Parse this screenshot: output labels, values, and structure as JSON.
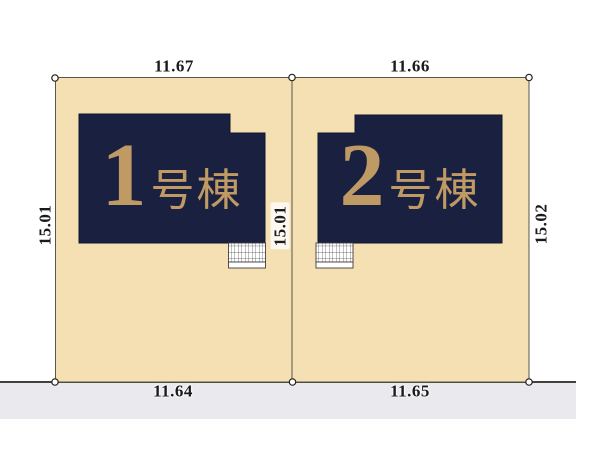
{
  "colors": {
    "lot_fill": "#F4E0B2",
    "building_fill": "#1A2140",
    "building_label": "#C09A64",
    "road_fill": "#E9E9EE",
    "boundary_line": "#44413A",
    "dimension_text": "#1A1A1A"
  },
  "buildings": [
    {
      "number": "1",
      "suffix": "号棟"
    },
    {
      "number": "2",
      "suffix": "号棟"
    }
  ],
  "dimensions": {
    "lot1_top": "11.67",
    "lot2_top": "11.66",
    "lot1_bottom": "11.64",
    "lot2_bottom": "11.65",
    "left_side": "15.01",
    "middle": "15.01",
    "right_side": "15.02"
  }
}
